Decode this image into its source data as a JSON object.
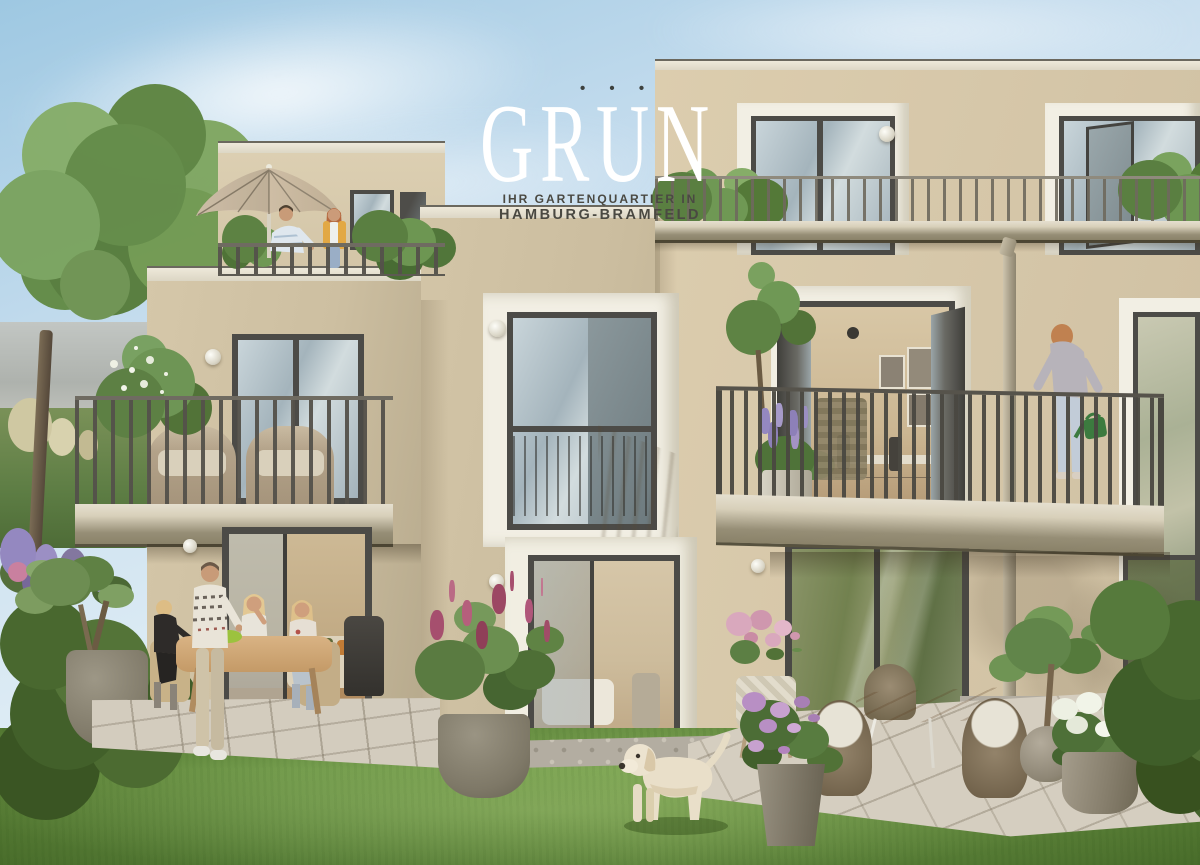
{
  "branding": {
    "wordmark": "GRÜN",
    "wordmark_display": "GRUN",
    "umlaut_dots": "• • •",
    "tagline_line1": "IHR GARTENQUARTIER IN",
    "tagline_line2": "HAMBURG-BRAMFELD"
  },
  "colors": {
    "sky_top": "#9ec8e2",
    "sky_mid": "#c6ddee",
    "sky_low": "#eef4f6",
    "facade_light": "#dccdae",
    "facade": "#d3c5a7",
    "facade_shadow": "#b7aa8d",
    "fascia_light": "#eee9da",
    "fascia_edge": "#6b685e",
    "slab_light": "#d8d0ba",
    "slab_dark": "#8a8269",
    "frame_dark": "#4c4b47",
    "white_trim": "#f2efe4",
    "glass_a": "#c9d5da",
    "glass_b": "#a4b4bc",
    "glass_green": "#8a9468",
    "railing_dark": "#54514a",
    "railing_ph": "#7b776c",
    "grass_light": "#7ba351",
    "grass": "#6b9344",
    "grass_dark": "#54792f",
    "hedge": "#49682f",
    "paver": "#d3ccbe",
    "gravel": "#b3ada1",
    "wood": "#c9a878",
    "parasol": "#d2c1aa",
    "lilac": "#a64f6e",
    "lavender": "#9488c0",
    "hydrangea_purple": "#b88fc4",
    "hydrangea_white": "#edf0e3",
    "pink": "#d9a8bd",
    "dog_cream": "#e9dfc9",
    "pot_gray": "#857e6d",
    "stone": "#a79f90",
    "logo_white": "#ffffff",
    "tagline": "#4a4942",
    "dot": "#3d413e",
    "skin": "#c89b78",
    "hair_blonde": "#ddbd85",
    "hair_ginger": "#b5683e",
    "yellow_cardigan": "#e2a844",
    "jeans": "#9aaec6",
    "sweater_gray": "#b7b3ba",
    "can_green": "#3c7b3f",
    "sofa": "#ddd2bb",
    "pillow_olive": "#77753f",
    "pillow_orange": "#c27c36",
    "interior_warm": "#cbb692",
    "wicker": "#b3a289",
    "cushion": "#d9d0bb",
    "rwicker": "#8c7d66"
  }
}
